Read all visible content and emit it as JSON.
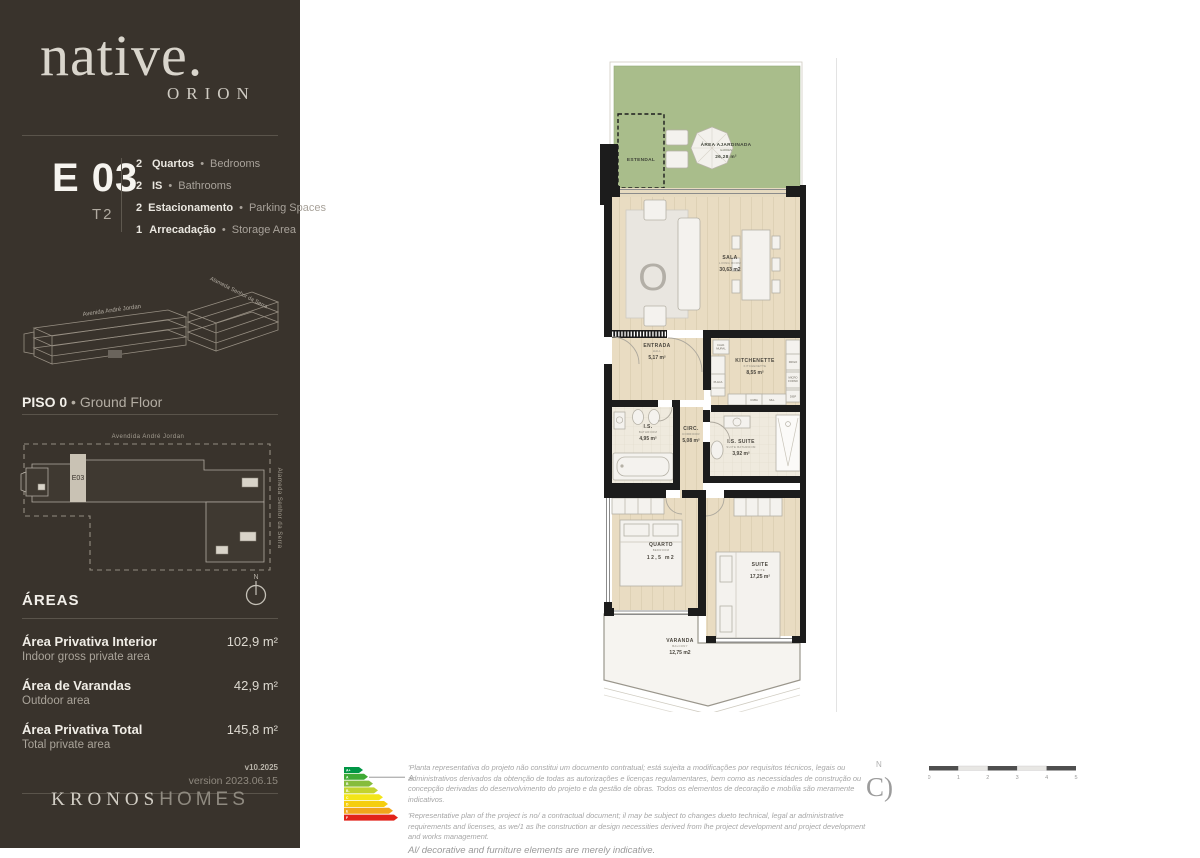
{
  "colors": {
    "sidebar_bg": "#39332c",
    "garden_green": "#a9bd8b",
    "floor_wood": "#e9dcc2",
    "wall_black": "#1c1c1c",
    "balcony_floor": "#f6f4f0"
  },
  "sidebar": {
    "brand": {
      "name": "native.",
      "sub": "ORION"
    },
    "unit": {
      "code": "E 03",
      "type": "T2",
      "bullet": "•",
      "features": [
        {
          "qty": "2",
          "pt": "Quartos",
          "en": "Bedrooms"
        },
        {
          "qty": "2",
          "pt": "IS",
          "en": "Bathrooms"
        },
        {
          "qty": "2",
          "pt": "Estacionamento",
          "en": "Parking Spaces"
        },
        {
          "qty": "1",
          "pt": "Arrecadação",
          "en": "Storage Area"
        }
      ]
    },
    "building": {
      "street1": "Avenida André Jordan",
      "street2": "Alameda Senhor da Serra"
    },
    "floor": {
      "pt": "PISO 0",
      "bullet": "•",
      "en": "Ground Floor"
    },
    "siteplan": {
      "street_top": "Avendida André Jordan",
      "street_right": "Alameda Senhor da Serra",
      "unit_label": "E03",
      "north": "N"
    },
    "areas": {
      "title": "ÁREAS",
      "rows": [
        {
          "pt": "Área Privativa Interior",
          "en": "Indoor gross private area",
          "value": "102,9 m²"
        },
        {
          "pt": "Área de Varandas",
          "en": "Outdoor area",
          "value": "42,9 m²"
        },
        {
          "pt": "Área Privativa Total",
          "en": "Total private area",
          "value": "145,8 m²"
        }
      ],
      "version_short": "v10.2025",
      "version_long": "version 2023.06.15"
    },
    "developer": {
      "name1": "KRONOS",
      "name2": "HOMES"
    }
  },
  "floorplan": {
    "rug_letter": "O",
    "rooms": {
      "garden": {
        "name": "ÁREA AJARDINADA",
        "sub": "GARDEN",
        "area": "26,28 m²"
      },
      "estendal": {
        "name": "ESTENDAL"
      },
      "sala": {
        "name": "SALA",
        "sub": "LIVING ROOM",
        "area": "30,63 m2"
      },
      "entrada": {
        "name": "ENTRADA",
        "sub": "HALL",
        "area": "5,17 m²"
      },
      "kitchenette": {
        "name": "KITCHENETTE",
        "sub": "KITCHENETTE",
        "area": "8,55 m²"
      },
      "is": {
        "name": "I.S.",
        "sub": "BATHROOM",
        "area": "4,95 m²"
      },
      "circ": {
        "name": "CIRC.",
        "sub": "CORRIDOR",
        "area": "5,08 m²"
      },
      "is_suite": {
        "name": "I.S. SUITE",
        "sub": "SUITE BATHROOM",
        "area": "3,92 m²"
      },
      "quarto": {
        "name": "QUARTO",
        "sub": "BEDROOM",
        "area": "12,5 m2"
      },
      "suite": {
        "name": "SUITE",
        "sub": "SUITE",
        "area": "17,25 m²"
      },
      "varanda": {
        "name": "VARANDA",
        "sub": "BALCONY",
        "area": "12,75 m2"
      }
    },
    "fixtures": {
      "cald_l1": "CALD.",
      "cald_l2": "MURAL",
      "frigo": "FRIGO",
      "micro_l1": "MICRO",
      "micro_l2": "FORNO",
      "disp": "DISP",
      "placa": "PLACA",
      "cuba": "CUBA",
      "mll": "MLL"
    }
  },
  "footer": {
    "energy": {
      "rating_label": "A",
      "bars": [
        "A+",
        "A",
        "B",
        "B-",
        "C",
        "D",
        "E",
        "F"
      ],
      "colors": [
        "#009645",
        "#3faa35",
        "#86bc3c",
        "#c3d32e",
        "#f3e518",
        "#f5ce0f",
        "#f0a51c",
        "#e2231a"
      ]
    },
    "disclaimer_pt": "'Planta representativa do projeto não constitui um documento contratual; está sujeita a modificações por requisitos técnicos, legais ou administrativos derivados da obtenção de todas as autorizações e licenças regulamentares, bem como as necessidades de construção ou concepção derivadas do desenvolvimento do projeto e da gestão de obras. Todos os elementos de decoração e mobília são meramente indicativos.",
    "disclaimer_en": "'Representative plan of the project is no/ a contractual document; il may be subject to changes dueto technical, legal ar administrative requirements and licenses, as we/1 as lhe construction ar design necessities derived from lhe project development and project development and works management.",
    "disclaimer_en2": "Al/ decorative and furniture elements are merely indicative.",
    "north_label": "N",
    "compass_glyph": "C)",
    "scale_ticks": [
      "0",
      "1",
      "2",
      "3",
      "4",
      "5"
    ]
  }
}
